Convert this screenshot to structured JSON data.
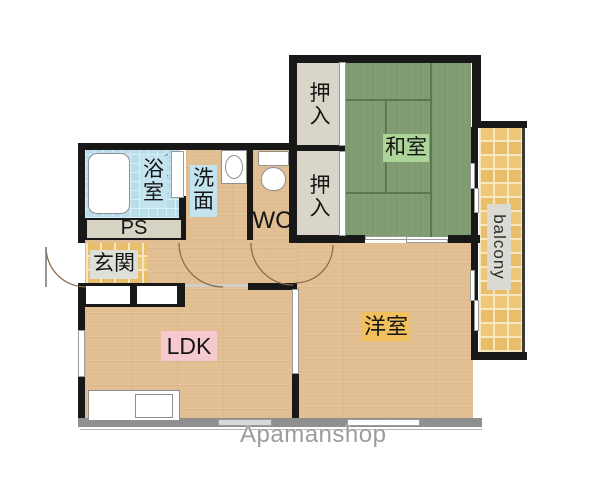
{
  "rooms": {
    "washitsu": "和室",
    "oshiire_upper": "押入",
    "oshiire_lower": "押入",
    "bath": "浴室",
    "senmen": "洗面",
    "wc": "WC",
    "ps": "PS",
    "genkan": "玄関",
    "ldk": "LDK",
    "yoshitsu": "洋室",
    "balcony": "balcony"
  },
  "watermark": "Apamanshop",
  "palette": {
    "wall": "#181818",
    "outer_wall_gray": "#8f8f8f",
    "tatami_green": "#7e9b72",
    "wood_floor": "#e2bf92",
    "bath_tile_blue": "#b9dde9",
    "balcony_tile_orange": "#eec878",
    "closet_beige": "#d9d5c8",
    "label_washitsu_bg": "#aed599",
    "label_ldk_bg": "#f6c9cf",
    "label_yoshitsu_bg": "#f2c05c",
    "label_bath_bg": "#c3e4ee",
    "label_gray_bg": "#dedfd8",
    "watermark_gray": "#9c9c9c"
  }
}
